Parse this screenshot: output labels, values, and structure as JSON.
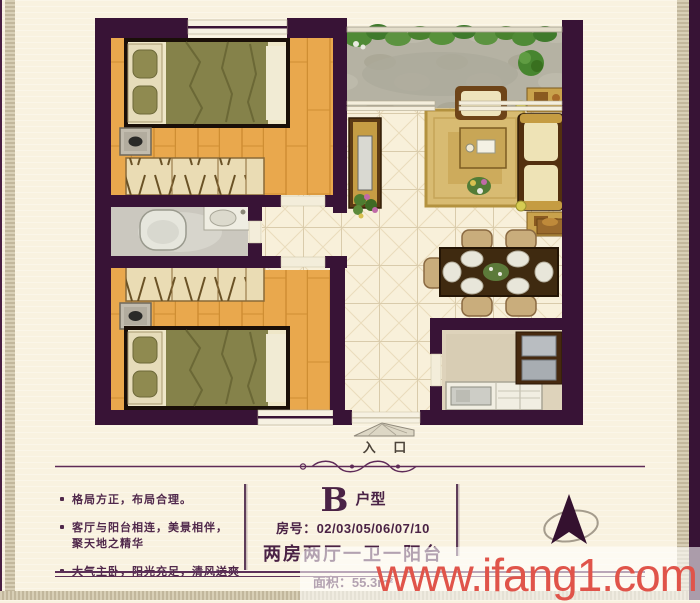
{
  "colors": {
    "wall": "#381336",
    "background": "#f9f2e0",
    "wood_floor": "#e9a84d",
    "tile_floor": "#f8f0da",
    "accent_purple": "#4a2245",
    "watermark_red": "#e0544a"
  },
  "plan": {
    "entry_label": "入 口"
  },
  "panel": {
    "bullets": [
      "格局方正，布局合理。",
      "客厅与阳台相连，美景相伴，\n聚天地之精华",
      "大气主卧，阳光充足，清风送爽"
    ],
    "unit_letter": "B",
    "unit_type": "户型",
    "room_line": "房号：02/03/05/06/07/10",
    "layout_line": "两房两厅一卫一阳台",
    "area_line": "面积：55.3m²"
  },
  "watermark": "www.ifang1.com"
}
